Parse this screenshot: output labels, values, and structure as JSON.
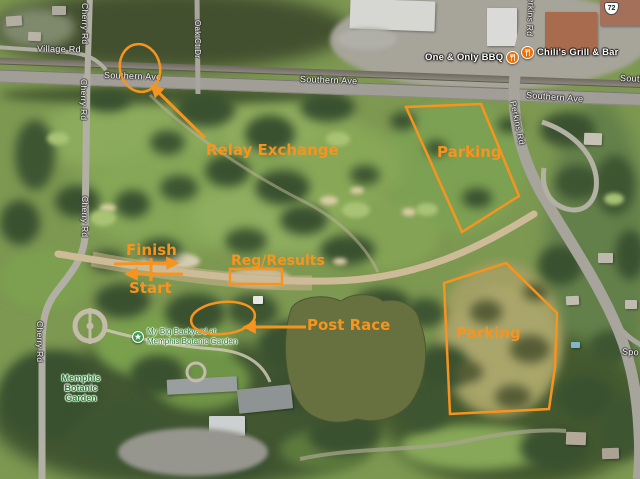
{
  "annotations": {
    "color": "#F7941E",
    "relay_exchange": "Relay Exchange",
    "parking_ne": "Parking",
    "parking_se": "Parking",
    "finish": "Finish",
    "start": "Start",
    "reg_results": "Reg/Results",
    "post_race": "Post Race"
  },
  "roads": {
    "village_rd": "Village Rd",
    "cherry_rd": "Cherry Rd",
    "southern_ave": "Southern Ave",
    "oak_ct_dr": "Oak Ct Dr",
    "perkins_rd": "Perkins Rd",
    "spottswood_partial": "Spo",
    "route_shield": "72"
  },
  "places": {
    "bbq": "One & Only BBQ",
    "chilis": "Chili's Grill & Bar",
    "backyard_line1": "My Big Backyard at",
    "backyard_line2": "Memphis Botanic Garden",
    "garden_line1": "Memphis",
    "garden_line2": "Botanic",
    "garden_line3": "Garden"
  }
}
